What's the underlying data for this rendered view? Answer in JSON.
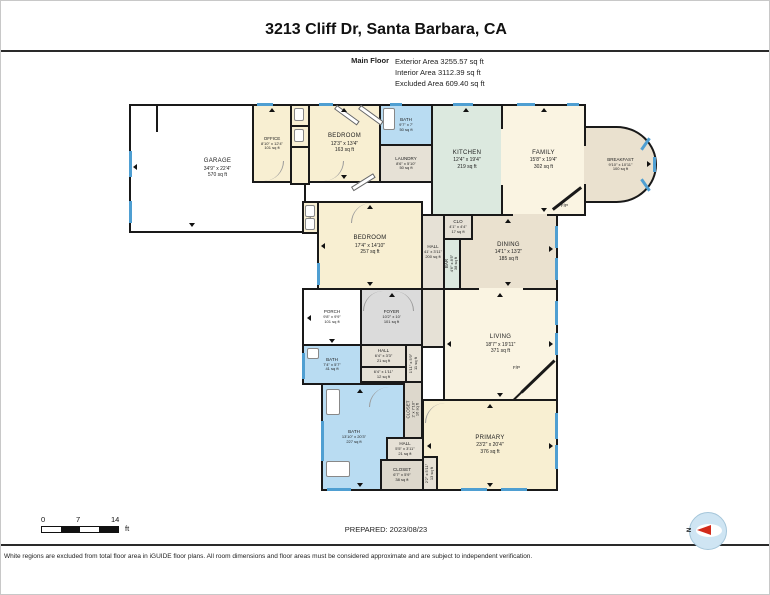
{
  "header": {
    "title": "3213 Cliff Dr, Santa Barbara, CA",
    "floor_label": "Main Floor",
    "summary_lines": {
      "exterior": "Exterior Area 3255.57 sq ft",
      "interior": "Interior Area 3112.39 sq ft",
      "excluded": "Excluded Area 609.40 sq ft"
    }
  },
  "rooms": {
    "garage": {
      "name": "GARAGE",
      "dims": "34'9\" x 22'4\"",
      "area": "570 sq ft"
    },
    "office": {
      "name": "OFFICE",
      "dims": "8'10\" x 12'4\"",
      "area": "101 sq ft"
    },
    "bedroom1": {
      "name": "BEDROOM",
      "dims": "12'3\" x 13'4\"",
      "area": "163 sq ft"
    },
    "bath_top": {
      "name": "BATH",
      "dims": "9'7\" x 7'",
      "area": "50 sq ft"
    },
    "laundry": {
      "name": "LAUNDRY",
      "dims": "8'6\" x 5'10\"",
      "area": "50 sq ft"
    },
    "kitchen": {
      "name": "KITCHEN",
      "dims": "12'4\" x 19'4\"",
      "area": "219 sq ft"
    },
    "family": {
      "name": "FAMILY",
      "dims": "15'8\" x 19'4\"",
      "area": "302 sq ft"
    },
    "breakfast": {
      "name": "BREAKFAST",
      "dims": "9'10\" x 10'11\"",
      "area": "100 sq ft"
    },
    "bedroom2": {
      "name": "BEDROOM",
      "dims": "17'4\" x 14'10\"",
      "area": "257 sq ft"
    },
    "clo_bedroom2": {
      "name": "CLO"
    },
    "hall_main": {
      "name": "HALL",
      "dims": "41' x 3'11\"",
      "area": "200 sq ft"
    },
    "clo_kitchen": {
      "name": "CLO",
      "dims": "4'1\" x 4'4\"",
      "area": "17 sq ft"
    },
    "bar": {
      "name": "BAR",
      "dims": "4'6\" x 8'5\"",
      "area": "38 sq ft"
    },
    "dining": {
      "name": "DINING",
      "dims": "14'1\" x 13'2\"",
      "area": "185 sq ft"
    },
    "porch": {
      "name": "PORCH",
      "dims": "9'8\" x 9'9\"",
      "area": "101 sq ft"
    },
    "foyer": {
      "name": "FOYER",
      "dims": "10'2\" x 10'",
      "area": "101 sq ft"
    },
    "living": {
      "name": "LIVING",
      "dims": "18'7\" x 19'11\"",
      "area": "371 sq ft"
    },
    "primary": {
      "name": "PRIMARY",
      "dims": "23'2\" x 20'4\"",
      "area": "376 sq ft"
    },
    "bath_small": {
      "name": "BATH",
      "dims": "7'4\" x 5'7\"",
      "area": "41 sq ft"
    },
    "hall_small": {
      "name": "HALL",
      "dims": "6'4\" x 3'3\"",
      "area": "21 sq ft"
    },
    "closet_strip": {
      "dims": "6'4\" x 1'11\"",
      "area": "12 sq ft"
    },
    "clo_side": {
      "dims": "1'11\" x 5'9\"",
      "area": "11 sq ft"
    },
    "closet_tall": {
      "name": "CLOSET",
      "dims": "2' x 7'10\"",
      "area": "16 sq ft"
    },
    "bath_big": {
      "name": "BATH",
      "dims": "13'10\" x 20'3\"",
      "area": "227 sq ft"
    },
    "hall_bottom": {
      "name": "HALL",
      "dims": "5'5\" x 3'11\"",
      "area": "21 sq ft"
    },
    "closet_bottom": {
      "name": "CLOSET",
      "dims": "6'7\" x 5'9\"",
      "area": "38 sq ft"
    },
    "clo_bottom": {
      "dims": "2'2\" x 5'11\"",
      "area": "13 sq ft"
    }
  },
  "plan": {
    "fireplace_label": "F/P"
  },
  "footer": {
    "scale": {
      "t0": "0",
      "t1": "7",
      "t2": "14",
      "unit": "ft"
    },
    "prepared": "PREPARED: 2023/08/23",
    "compass_label": "N",
    "disclaimer": "White regions are excluded from total floor area in iGUIDE floor plans. All room dimensions and floor areas must be considered approximate and are subject to independent verification."
  },
  "colors": {
    "wall": "#191919",
    "window": "#4f9fd2",
    "room_cream": "#f8efd2",
    "room_cream_light": "#faf4e2",
    "kitchen_teal": "#dce9df",
    "bath_blue": "#b9dcf2",
    "foyer_gray": "#dbdbdb",
    "dining_tan": "#eae1cf",
    "utility": "#e6e1d6",
    "closet": "#ddd8cc",
    "compass_red": "#d22a1a",
    "compass_blue": "#cfe5f3"
  }
}
